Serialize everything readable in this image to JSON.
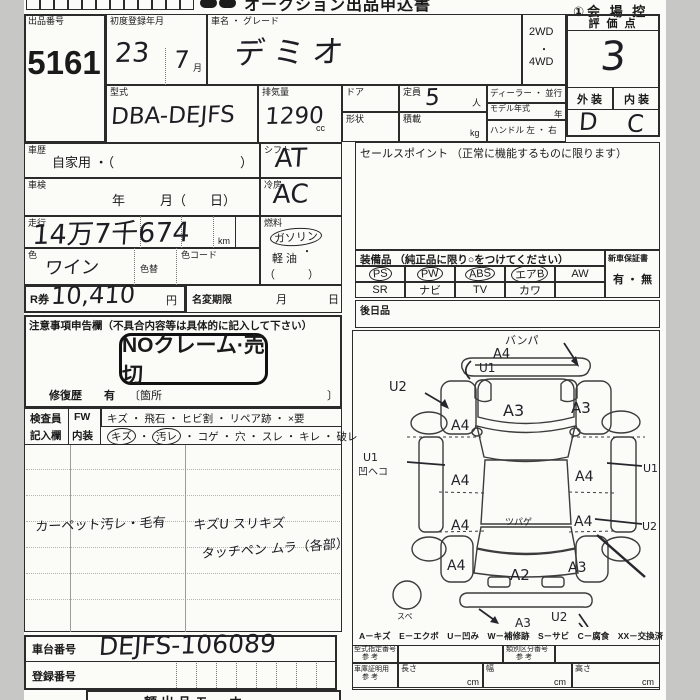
{
  "header": {
    "title": "オークション出品申込書",
    "venue": "①会 場 控"
  },
  "top": {
    "lot_label": "出品番号",
    "lot": "5161",
    "first_reg_label": "初度登録年月",
    "first_reg_year": "23",
    "first_reg_month": "7",
    "month_suffix": "月",
    "name_label": "車名 ・ グレード",
    "name": "デミオ",
    "model_label": "型式",
    "model": "DBA-DEJFS",
    "disp_label": "排気量",
    "disp": "1290",
    "disp_unit": "cc",
    "drive_1": "2WD",
    "drive_dot": "・",
    "drive_2": "4WD",
    "door_label": "ドア",
    "capacity_label": "定員",
    "capacity": "5",
    "capacity_unit": "人",
    "shape_label": "形状",
    "load_label": "積載",
    "load_unit": "kg",
    "dealer_label": "ディーラー ・ 並行",
    "model_year_label": "モデル年式",
    "model_year_unit": "年",
    "handle_label": "ハンドル 左 ・ 右",
    "score_label": "評 価 点",
    "score": "3",
    "exterior_label": "外 装",
    "interior_label": "内 装",
    "exterior": "D",
    "interior": "C"
  },
  "mid": {
    "history_label": "車歴",
    "history_value": "自家用 ・（",
    "history_close": "）",
    "shaken_label": "車検",
    "shaken_year": "年",
    "shaken_month": "月（",
    "shaken_day": "日）",
    "mileage_label": "走行",
    "mileage": "14万7千674",
    "mileage_unit": "km",
    "color_label": "色",
    "color": "ワイン",
    "color_change_label": "色替",
    "color_code_label": "色コード",
    "shift_label": "シフト",
    "shift": "AT",
    "ac_label": "冷房",
    "ac": "AC",
    "fuel_label": "燃料",
    "fuel_1": "ガソリン",
    "fuel_dot": "・",
    "fuel_2": "軽 油",
    "fuel_paren": "（　　　）",
    "rticket_label": "R券",
    "rticket": "10,410",
    "yen": "円",
    "name_change_label": "名変期限",
    "month": "月",
    "day": "日"
  },
  "sales": {
    "label": "セールスポイント （正常に機能するものに限ります）"
  },
  "equipment": {
    "label": "装備品 （純正品に限り○をつけてください）",
    "row1": [
      "PS",
      "PW",
      "ABS",
      "エアB",
      "AW"
    ],
    "row1_circled": [
      true,
      true,
      true,
      true,
      false
    ],
    "row2": [
      "SR",
      "ナビ",
      "TV",
      "カワ",
      ""
    ],
    "warranty_label": "新車保証書",
    "warranty_value": "有 ・ 無",
    "later_label": "後日品"
  },
  "caution": {
    "label": "注意事項申告欄（不具合内容等は具体的に記入して下さい）",
    "stamp": "NOクレーム·売切",
    "repair_label": "修復歴",
    "repair_value": "有",
    "repair_bracket_open": "〔箇所",
    "repair_bracket_close": "〕"
  },
  "inspector": {
    "col_label_1": "検査員",
    "col_label_2": "記入欄",
    "row1_key": "FW",
    "row1_item_1": "キズ",
    "row1_rest": "・ 飛石 ・ ヒビ割 ・ リペア跡 ・ ×要",
    "row2_key": "内装",
    "row2_item_1": "キズ",
    "row2_dot": "・",
    "row2_item_2": "汚レ",
    "row2_rest": "・ コゲ ・ 穴 ・ スレ ・ キレ ・ 破レ"
  },
  "remarks": {
    "note_1": "カーペット汚レ・毛有",
    "note_2": "キズU スリキズ",
    "note_3": "タッチペン ムラ（各部）"
  },
  "bottom": {
    "chassis_label": "車台番号",
    "chassis": "DEJFS-106089",
    "registration_label": "登録番号",
    "cut_off_text": "額出品モ　ホ"
  },
  "diagram": {
    "legend": "A－キズ　E－エクボ　U－凹み　W－補修跡　S－サビ　C－腐食　XX－交換済",
    "spare_label": "スペ",
    "ann": {
      "front_bumper_note": "バンパ",
      "front_bumper_a": "A4",
      "front_bumper_u": "U1",
      "front_left_u": "U2",
      "hood": "A3",
      "front_right_fender": "A3",
      "front_left_fender": "A4",
      "left_side_u": "U1",
      "left_side_note": "凹ヘコ",
      "left_front_door": "A4",
      "right_front_door": "A4",
      "right_side_u": "U1",
      "left_rear_door": "A4",
      "right_rear_door": "A4",
      "right_side_u2": "U2",
      "roof_note": "ツパゲ",
      "left_rear_quarter": "A4",
      "tailgate": "A2",
      "right_rear_quarter": "A3",
      "rear_bottom_u": "U2",
      "rear_bumper_a": "A3"
    }
  },
  "refs": {
    "model_desig_label": "型式指定番号",
    "ref_1": "参 考",
    "class_label": "類別区分番号",
    "ref_2": "参 考",
    "garage_label": "車庫証明用",
    "ref_3": "参 考",
    "length_label": "長さ",
    "width_label": "幅",
    "height_label": "高さ",
    "cm_1": "cm",
    "cm_2": "cm",
    "cm_3": "cm"
  }
}
